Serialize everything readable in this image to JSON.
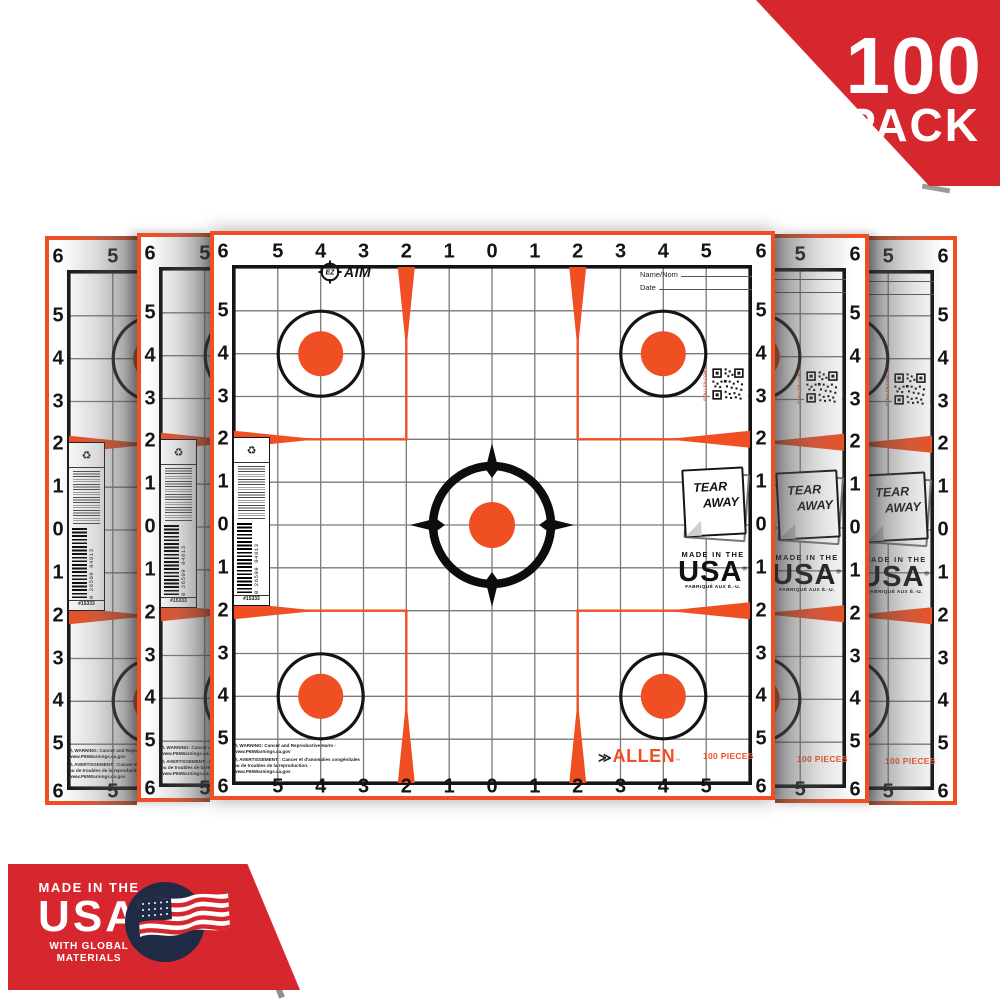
{
  "colors": {
    "orange": "#F04E23",
    "red": "#D7272E",
    "navy": "#1F2A44",
    "grid_gray": "#7A7A7A",
    "ink": "#141414"
  },
  "pack_badge": {
    "count": "100",
    "label": "PACK"
  },
  "usa_badge": {
    "line1": "MADE IN THE",
    "line2": "USA",
    "line3": "WITH GLOBAL",
    "line4": "MATERIALS",
    "flag_icon": "us-flag-icon"
  },
  "sheet_count": 5,
  "target_sheet": {
    "ruler_numbers": [
      "6",
      "5",
      "4",
      "3",
      "2",
      "1",
      "0",
      "1",
      "2",
      "3",
      "4",
      "5",
      "6"
    ],
    "logo_ez": "EZ",
    "logo_aim": "AIM",
    "name_field_label": "Name/Nom",
    "date_field_label": "Date",
    "qr_caption": "BYALLEN.COM",
    "tear_away_line1": "TEAR",
    "tear_away_line2": "AWAY",
    "made_in_usa": {
      "line1": "MADE IN THE",
      "line2": "USA",
      "reg": "®",
      "line3": "FABRIQUÉ AUX É.-U."
    },
    "barcode": {
      "digits": "0 26509 04813",
      "item_number": "#15333"
    },
    "allen_logo": "ALLEN",
    "allen_tm": "™",
    "pieces_label": "100 PIECES",
    "warning_en": "⚠ WARNING: Cancer and Reproductive Harm - www.P65Warnings.ca.gov",
    "warning_fr": "⚠ AVERTISSEMENT : Cancer et d'anomalies congénitales ou de troubles de la reproduction. - www.P65Warnings.ca.gov"
  }
}
